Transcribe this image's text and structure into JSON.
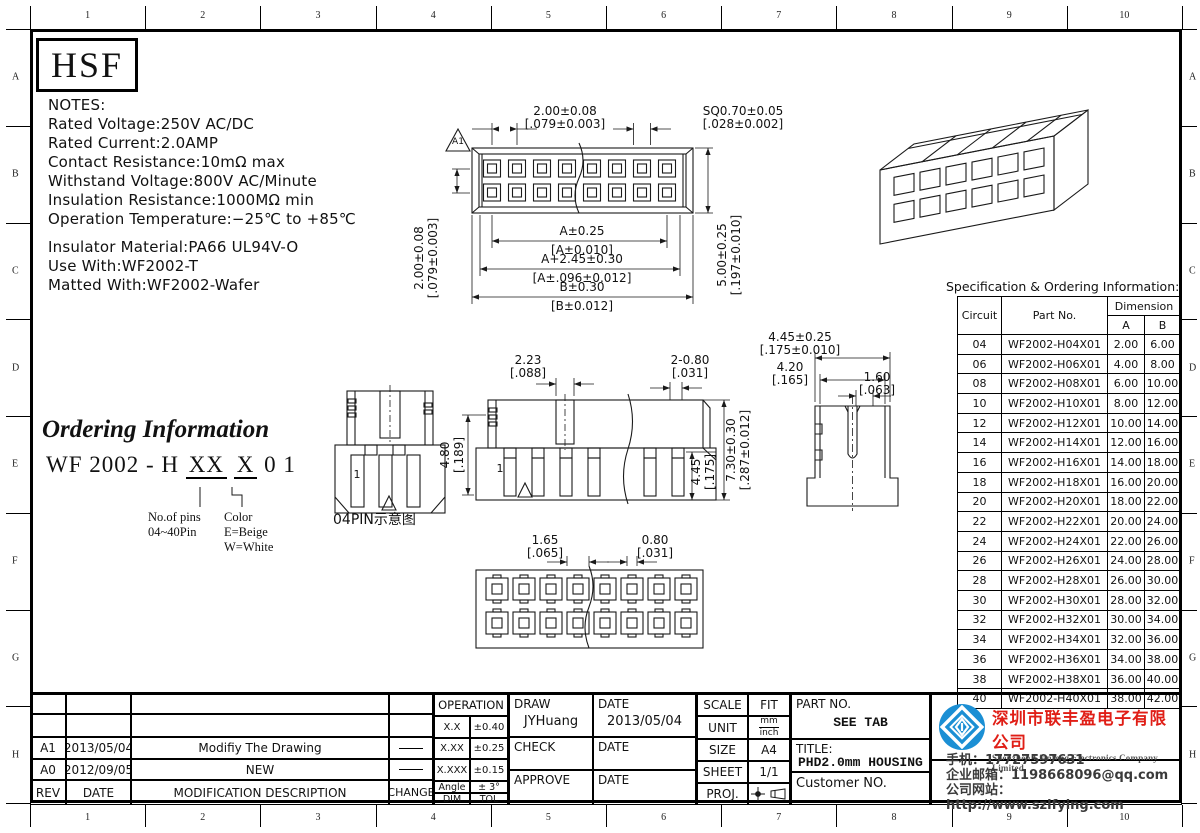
{
  "page": {
    "border_numbers": [
      "1",
      "2",
      "3",
      "4",
      "5",
      "6",
      "7",
      "8",
      "9",
      "10"
    ],
    "border_letters": [
      "A",
      "B",
      "C",
      "D",
      "E",
      "F",
      "G",
      "H"
    ]
  },
  "logo": {
    "text": "HSF"
  },
  "notes": {
    "title": "NOTES:",
    "lines": [
      "Rated Voltage:250V AC/DC",
      "Rated Current:2.0AMP",
      "Contact Resistance:10mΩ max",
      "Withstand Voltage:800V AC/Minute",
      "Insulation Resistance:1000MΩ min",
      "Operation Temperature:−25℃ to +85℃"
    ],
    "lines2": [
      "Insulator Material:PA66 UL94V-O",
      "Use With:WF2002-T",
      "Matted With:WF2002-Wafer"
    ]
  },
  "ordering": {
    "title": "Ordering Information",
    "code_prefix": "WF 2002 - H",
    "code_pins": "XX",
    "code_color": "X",
    "code_suffix": "0 1",
    "pins_label": "No.of pins",
    "pins_range": "04~40Pin",
    "color_label": "Color",
    "color_opt1": "E=Beige",
    "color_opt2": "W=White"
  },
  "drawings": {
    "front_view": {
      "flag": "A1",
      "pitch": {
        "mm": "2.00±0.08",
        "in": "[.079±0.003]"
      },
      "sq": {
        "mm": "SQ0.70±0.05",
        "in": "[.028±0.002]"
      },
      "row_pitch": {
        "mm": "2.00±0.08",
        "in": "[.079±0.003]"
      },
      "dim_a": {
        "mm": "A±0.25",
        "in": "[A±0.010]"
      },
      "dim_a245": {
        "mm": "A+2.45±0.30",
        "in": "[A±.096±0.012]"
      },
      "dim_b": {
        "mm": "B±0.30",
        "in": "[B±0.012]"
      },
      "height": {
        "mm": "5.00±0.25",
        "in": "[.197±0.010]"
      }
    },
    "side_small": {
      "pin_label": "1",
      "caption": "04PIN示意图"
    },
    "side_large": {
      "pin_label": "1",
      "d223": {
        "mm": "2.23",
        "in": "[.088]"
      },
      "d480": {
        "mm": "4.80",
        "in": "[.189]"
      },
      "d2080": {
        "mm": "2-0.80",
        "in": "[.031]"
      },
      "d445": {
        "mm": "4.45",
        "in": "[.175]"
      },
      "d730": {
        "mm": "7.30±0.30",
        "in": "[.287±0.012]"
      }
    },
    "end_view": {
      "d445": {
        "mm": "4.45±0.25",
        "in": "[.175±0.010]"
      },
      "d420": {
        "mm": "4.20",
        "in": "[.165]"
      },
      "d160": {
        "mm": "1.60",
        "in": "[.063]"
      }
    },
    "rear_view": {
      "d165": {
        "mm": "1.65",
        "in": "[.065]"
      },
      "d080": {
        "mm": "0.80",
        "in": "[.031]"
      }
    }
  },
  "spec_table": {
    "title": "Specification & Ordering Information:",
    "col_circuit": "Circuit",
    "col_part": "Part No.",
    "col_dimension": "Dimension",
    "col_a": "A",
    "col_b": "B",
    "rows": [
      [
        "04",
        "WF2002-H04X01",
        "2.00",
        "6.00"
      ],
      [
        "06",
        "WF2002-H06X01",
        "4.00",
        "8.00"
      ],
      [
        "08",
        "WF2002-H08X01",
        "6.00",
        "10.00"
      ],
      [
        "10",
        "WF2002-H10X01",
        "8.00",
        "12.00"
      ],
      [
        "12",
        "WF2002-H12X01",
        "10.00",
        "14.00"
      ],
      [
        "14",
        "WF2002-H14X01",
        "12.00",
        "16.00"
      ],
      [
        "16",
        "WF2002-H16X01",
        "14.00",
        "18.00"
      ],
      [
        "18",
        "WF2002-H18X01",
        "16.00",
        "20.00"
      ],
      [
        "20",
        "WF2002-H20X01",
        "18.00",
        "22.00"
      ],
      [
        "22",
        "WF2002-H22X01",
        "20.00",
        "24.00"
      ],
      [
        "24",
        "WF2002-H24X01",
        "22.00",
        "26.00"
      ],
      [
        "26",
        "WF2002-H26X01",
        "24.00",
        "28.00"
      ],
      [
        "28",
        "WF2002-H28X01",
        "26.00",
        "30.00"
      ],
      [
        "30",
        "WF2002-H30X01",
        "28.00",
        "32.00"
      ],
      [
        "32",
        "WF2002-H32X01",
        "30.00",
        "34.00"
      ],
      [
        "34",
        "WF2002-H34X01",
        "32.00",
        "36.00"
      ],
      [
        "36",
        "WF2002-H36X01",
        "34.00",
        "38.00"
      ],
      [
        "38",
        "WF2002-H38X01",
        "36.00",
        "40.00"
      ],
      [
        "40",
        "WF2002-H40X01",
        "38.00",
        "42.00"
      ]
    ]
  },
  "revisions": {
    "header": {
      "rev": "REV",
      "date": "DATE",
      "desc": "MODIFICATION  DESCRIPTION",
      "change": "CHANGE"
    },
    "rows": [
      {
        "rev": "A1",
        "date": "2013/05/04",
        "desc": "Modifiy The Drawing"
      },
      {
        "rev": "A0",
        "date": "2012/09/05",
        "desc": "NEW"
      }
    ]
  },
  "titleblock": {
    "operation": {
      "title": "OPERATION",
      "rows": [
        [
          "X.X",
          "±0.40"
        ],
        [
          "X.XX",
          "±0.25"
        ],
        [
          "X.XXX",
          "±0.15"
        ],
        [
          "Angle",
          "± 3°"
        ],
        [
          "DIM",
          "TOL"
        ]
      ]
    },
    "draw_label": "DRAW",
    "draw_name": "JYHuang",
    "date_label": "DATE",
    "draw_date": "2013/05/04",
    "check_label": "CHECK",
    "approve_label": "APPROVE",
    "scale_label": "SCALE",
    "scale_value": "FIT",
    "unit_label": "UNIT",
    "unit_top": "mm",
    "unit_bottom": "inch",
    "size_label": "SIZE",
    "size_value": "A4",
    "sheet_label": "SHEET",
    "sheet_value": "1/1",
    "proj_label": "PROJ.",
    "partno_label": "PART NO.",
    "partno_value": "SEE TAB",
    "title_label": "TITLE:",
    "title_value": "PHD2.0mm HOUSING",
    "customer_label": "Customer NO."
  },
  "company": {
    "name_cn": "深圳市联丰盈电子有限公司",
    "name_en": "Shenzhen Lianfeng Electronics Company Limited",
    "phone": "手机：17727597631",
    "email": "企业邮箱：1198668096@qq.com",
    "website": "公司网站：http://www.szlfying.com",
    "brand_blue": "#1b8fd4",
    "brand_red": "#e01e16"
  }
}
